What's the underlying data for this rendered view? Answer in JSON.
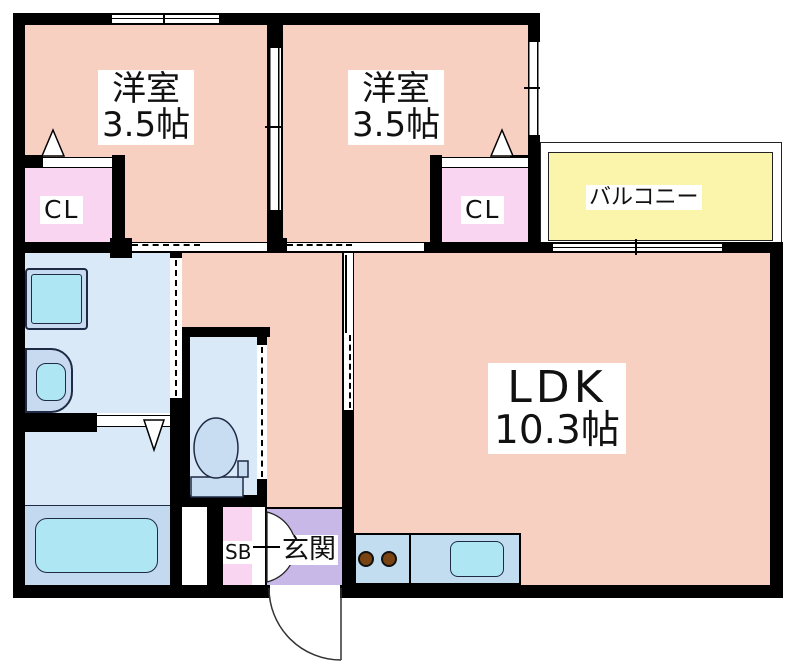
{
  "rooms": {
    "bedroom1": {
      "type": "洋室",
      "size": "3.5帖"
    },
    "bedroom2": {
      "type": "洋室",
      "size": "3.5帖"
    },
    "ldk": {
      "type": "LDK",
      "size": "10.3帖"
    },
    "balcony": {
      "label": "バルコニー"
    },
    "entrance": {
      "label": "玄関"
    },
    "closet1": {
      "label": "CL"
    },
    "closet2": {
      "label": "CL"
    },
    "shoebox": {
      "label": "SB"
    }
  },
  "colors": {
    "wall": "#000000",
    "room": "#F8D0C2",
    "closet": "#F9D5F2",
    "balcony": "#FBF5AB",
    "entrance": "#C8B8E8",
    "wet": "#D9E9F8",
    "fixture2": "#C3D9F0",
    "appliance": "#C7DAEF",
    "water": "#AEE7F3",
    "counter": "#C2DCF0",
    "burner": "#7A4412"
  }
}
